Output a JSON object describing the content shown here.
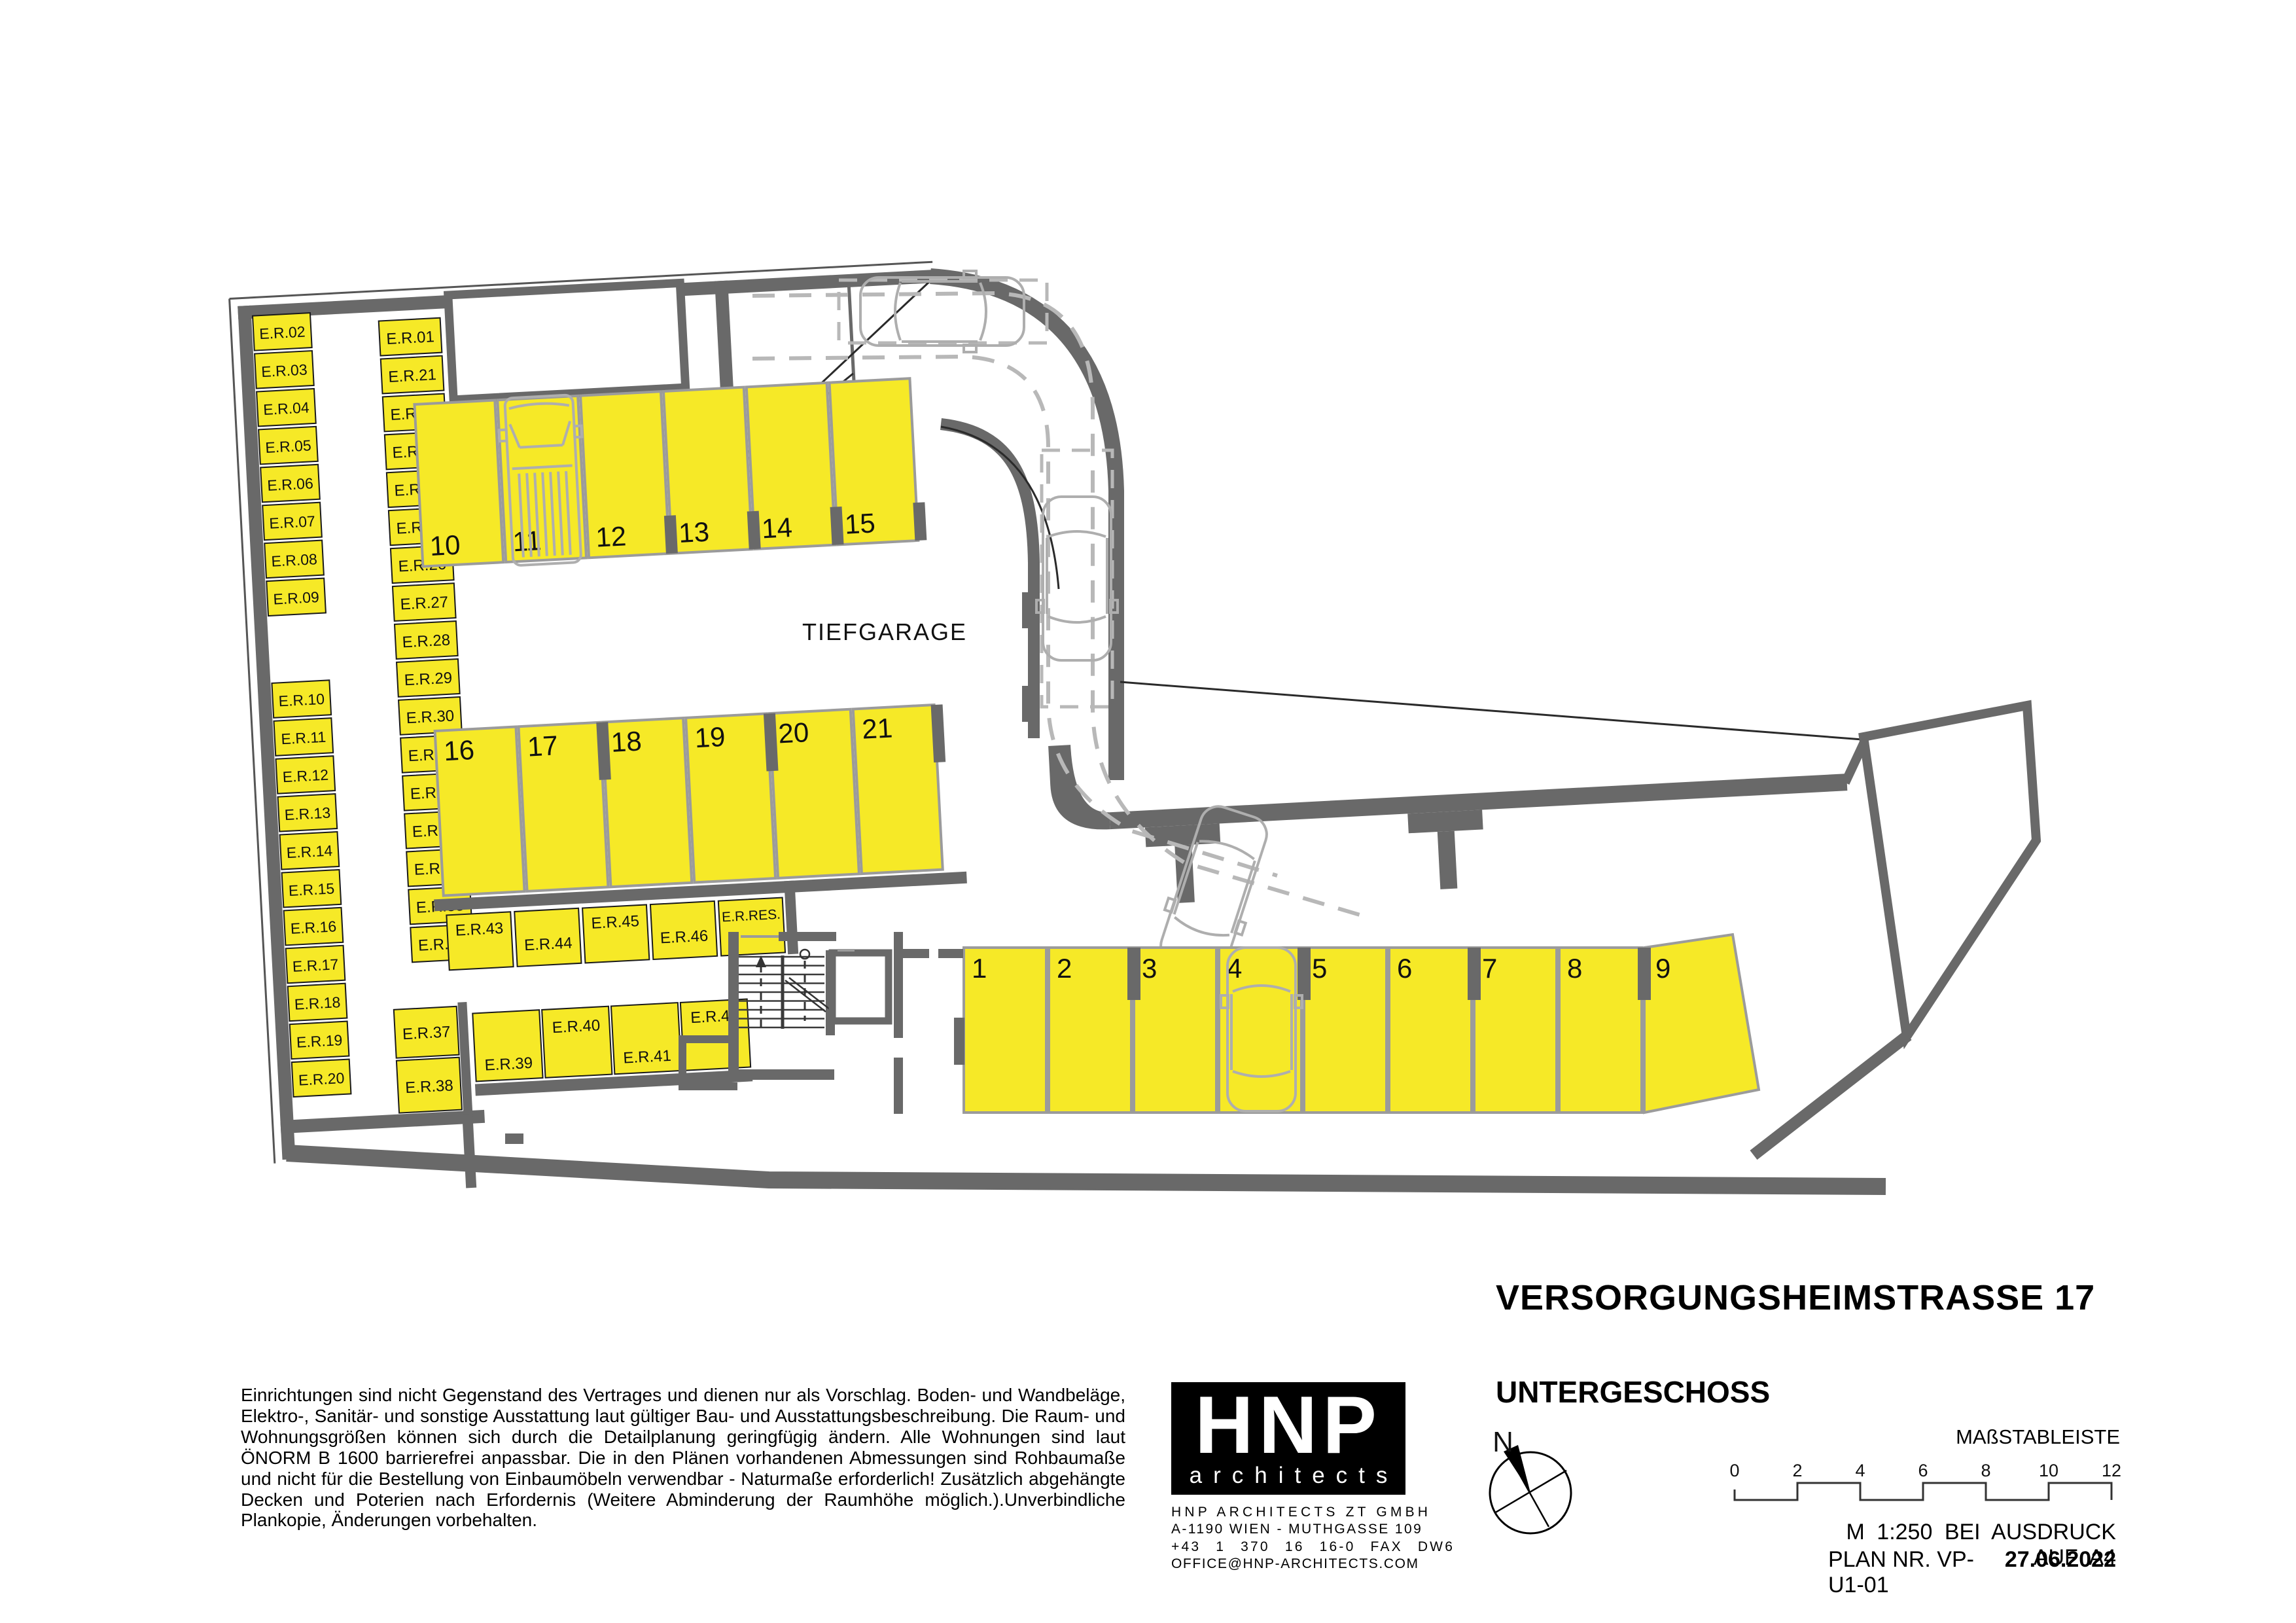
{
  "plan": {
    "area_label": "TIEFGARAGE",
    "storage_col_a_top": [
      "E.R.02",
      "E.R.03",
      "E.R.04",
      "E.R.05",
      "E.R.06",
      "E.R.07",
      "E.R.08",
      "E.R.09"
    ],
    "storage_col_a_bottom": [
      "E.R.10",
      "E.R.11",
      "E.R.12",
      "E.R.13",
      "E.R.14",
      "E.R.15",
      "E.R.16",
      "E.R.17",
      "E.R.18",
      "E.R.19",
      "E.R.20"
    ],
    "storage_col_b": [
      "E.R.01",
      "E.R.21",
      "E.R.22",
      "E.R.23",
      "E.R.24",
      "E.R.25",
      "E.R.26",
      "E.R.27",
      "E.R.28",
      "E.R.29",
      "E.R.30",
      "E.R.31",
      "E.R.32",
      "E.R.33",
      "E.R.34",
      "E.R.35",
      "E.R.36"
    ],
    "storage_mid_row": [
      "E.R.43",
      "E.R.44",
      "E.R.45",
      "E.R.46",
      "E.R.RES."
    ],
    "storage_low_left": [
      "E.R.37",
      "E.R.38"
    ],
    "storage_low_row": [
      "E.R.39",
      "E.R.40",
      "E.R.41",
      "E.R.42"
    ],
    "stalls_top": [
      "10",
      "11",
      "12",
      "13",
      "14",
      "15"
    ],
    "stalls_mid": [
      "16",
      "17",
      "18",
      "19",
      "20",
      "21"
    ],
    "stalls_bottom": [
      "1",
      "2",
      "3",
      "4",
      "5",
      "6",
      "7",
      "8",
      "9"
    ],
    "compass_label": "N"
  },
  "title_block": {
    "title": "VERSORGUNGSHEIMSTRASSE 17",
    "subtitle": "UNTERGESCHOSS"
  },
  "disclaimer": "Einrichtungen sind nicht Gegenstand des Vertrages und dienen nur als Vorschlag. Boden- und Wandbeläge, Elektro-, Sanitär- und sonstige Ausstattung laut gültiger Bau- und Ausstattungsbeschreibung. Die Raum- und Wohnungsgrößen können sich durch die Detailplanung geringfügig ändern. Alle Wohnungen sind laut ÖNORM B 1600 barrierefrei anpassbar. Die in den Plänen vorhandenen Abmessungen sind Rohbaumaße und nicht für die Bestellung von Einbaumöbeln verwendbar - Naturmaße erforderlich! Zusätzlich abgehängte Decken und Poterien nach Erfordernis (Weitere Abminderung der Raumhöhe möglich.).Unverbindliche Plankopie, Änderungen vorbehalten.",
  "logo": {
    "name": "HNP",
    "tagline": "architects",
    "address_lines": [
      "HNP ARCHITECTS ZT GMBH",
      "A-1190 WIEN - MUTHGASSE 109",
      "+43 1 370 16 16-0 FAX DW6",
      "OFFICE@HNP-ARCHITECTS.COM"
    ]
  },
  "scale_bar": {
    "label": "MAßSTABLEISTE",
    "ticks": [
      "0",
      "2",
      "4",
      "6",
      "8",
      "10",
      "12"
    ],
    "print_note": "M 1:250 BEI AUSDRUCK AUF A4",
    "plan_no": "PLAN NR. VP-U1-01",
    "date": "27.06.2022"
  },
  "colors": {
    "stall_fill": "#F6E927",
    "wall": "#696969",
    "stall_border": "#9B9B9B",
    "cell_border": "#1A1A1A",
    "car_outline": "#AEAEAE",
    "dash_line": "#B8B8B8"
  }
}
